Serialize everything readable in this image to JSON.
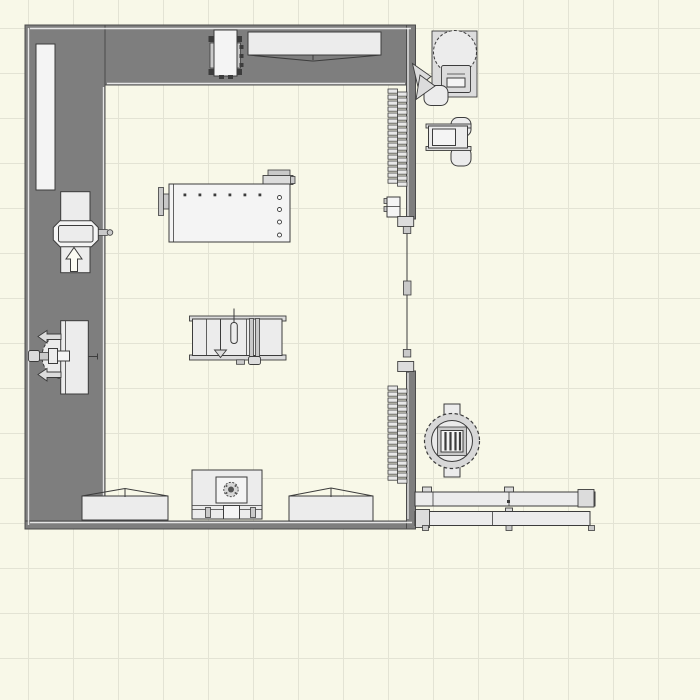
{
  "canvas": {
    "width": 700,
    "height": 700,
    "grid_size": 45,
    "grid_offset": 28
  },
  "palette": {
    "background": "#F8F8E8",
    "grid_line": "#E3E3D4",
    "wall_fill": "#7E7E7E",
    "wall_border": "#4B4B4B",
    "wall_highlight": "#FFFFFF",
    "equipment_fill": "#ECECEC",
    "equipment_outline": "#3C3C3C"
  },
  "coil": {
    "teeth": 16,
    "pitch": 6,
    "tooth_width": 9.5,
    "tooth_height": 4.2
  },
  "objects": [
    "wall-shelf",
    "rolling-tool-cart",
    "workbench-top",
    "air-compressor",
    "benchtop-planer",
    "coil-door-section-upper",
    "coil-door-section-lower",
    "small-panel-box",
    "sliding-door",
    "workbench-main",
    "jointer",
    "radial-arm-saw",
    "table-saw",
    "drill-press",
    "workbench-bottom-left",
    "workbench-bottom-right",
    "shop-vacuum",
    "clamp-rack"
  ]
}
